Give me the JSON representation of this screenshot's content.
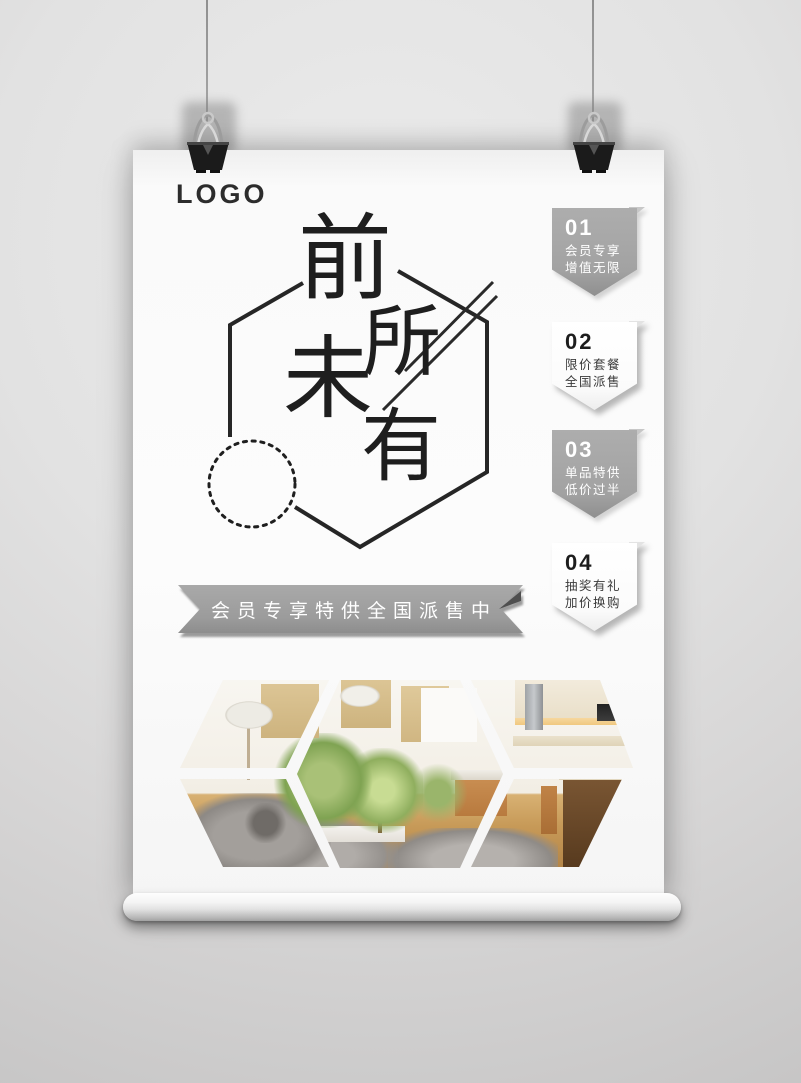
{
  "poster": {
    "logo": "LOGO",
    "title": {
      "chars": [
        "前",
        "所",
        "未",
        "有"
      ],
      "meaning_note": "",
      "decor": [
        "hexagon-outline",
        "dotted-circle",
        "double-slash"
      ]
    },
    "badges": [
      {
        "number": "01",
        "line1": "会员专享",
        "line2": "增值无限",
        "variant": "gray"
      },
      {
        "number": "02",
        "line1": "限价套餐",
        "line2": "全国派售",
        "variant": "white"
      },
      {
        "number": "03",
        "line1": "单品特供",
        "line2": "低价过半",
        "variant": "gray"
      },
      {
        "number": "04",
        "line1": "抽奖有礼",
        "line2": "加价换购",
        "variant": "white"
      }
    ],
    "ribbon": {
      "text": "会员专享特供全国派售中"
    },
    "photos": [
      "living-room-floor-lamp-photo",
      "gray-sofa-closeup-photo",
      "living-dining-room-photo",
      "kitchen-counter-photo",
      "kitchen-island-photo"
    ]
  },
  "colors": {
    "wall": "#d9d9d9",
    "paper": "#fbfbfb",
    "ink": "#1e1e1e",
    "badge_gray": "#a2a2a2",
    "badge_white": "#ffffff",
    "ribbon_gray": "#9b9b9b"
  }
}
